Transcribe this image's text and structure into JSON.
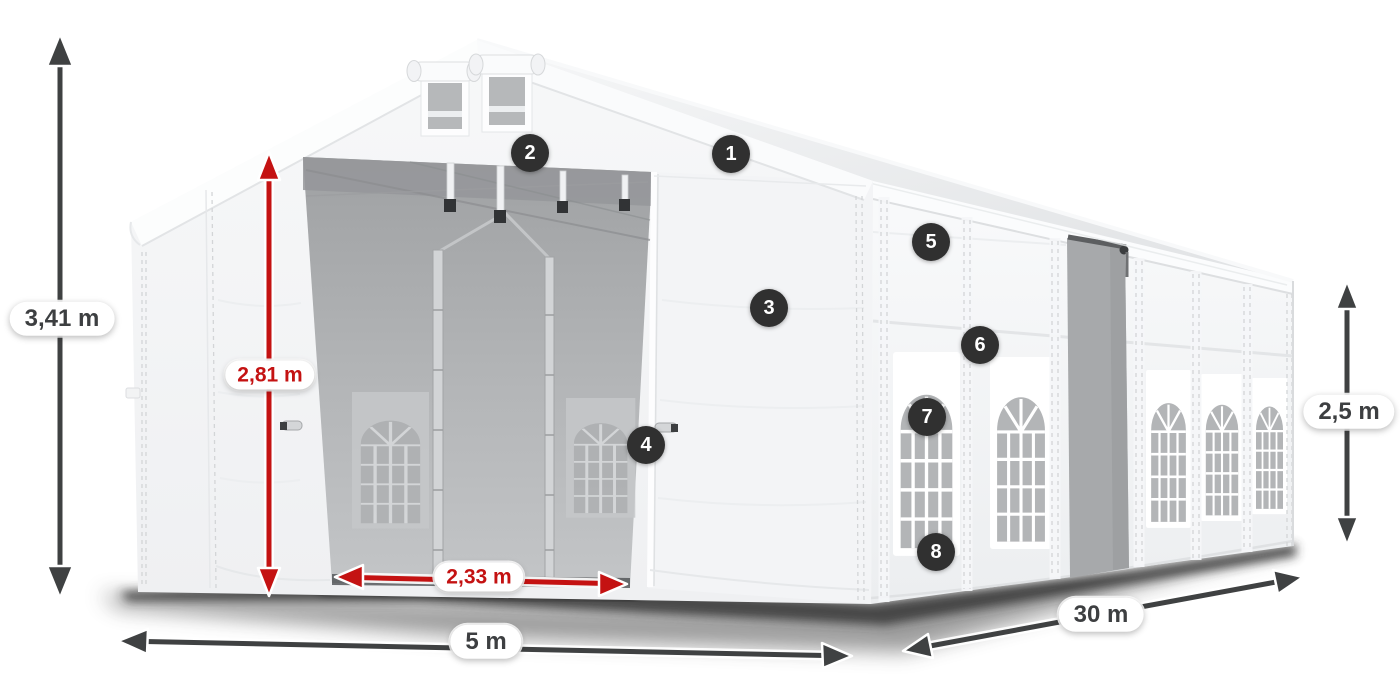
{
  "diagram": {
    "subject": "party-tent-dimension-diagram",
    "dimensions": [
      {
        "id": "total_height",
        "label": "3,41 m",
        "style": "dark",
        "orientation": "vertical"
      },
      {
        "id": "entrance_height",
        "label": "2,81 m",
        "style": "red",
        "orientation": "vertical"
      },
      {
        "id": "entrance_width",
        "label": "2,33 m",
        "style": "red",
        "orientation": "horizontal"
      },
      {
        "id": "tent_width",
        "label": "5 m",
        "style": "dark",
        "orientation": "horizontal"
      },
      {
        "id": "tent_length",
        "label": "30 m",
        "style": "dark",
        "orientation": "diagonal"
      },
      {
        "id": "side_wall_height",
        "label": "2,5 m",
        "style": "dark",
        "orientation": "vertical"
      }
    ],
    "callouts": [
      {
        "number": "1"
      },
      {
        "number": "2"
      },
      {
        "number": "3"
      },
      {
        "number": "4"
      },
      {
        "number": "5"
      },
      {
        "number": "6"
      },
      {
        "number": "7"
      },
      {
        "number": "8"
      }
    ],
    "colors": {
      "dimension_red": "#c41212",
      "dimension_dark": "#3f4142",
      "badge_background": "#303030",
      "badge_text": "#ffffff",
      "label_background": "#ffffff",
      "tent_white": "#f5f6f7",
      "interior_gray": "#a7a9ab",
      "background": "#ffffff"
    }
  }
}
